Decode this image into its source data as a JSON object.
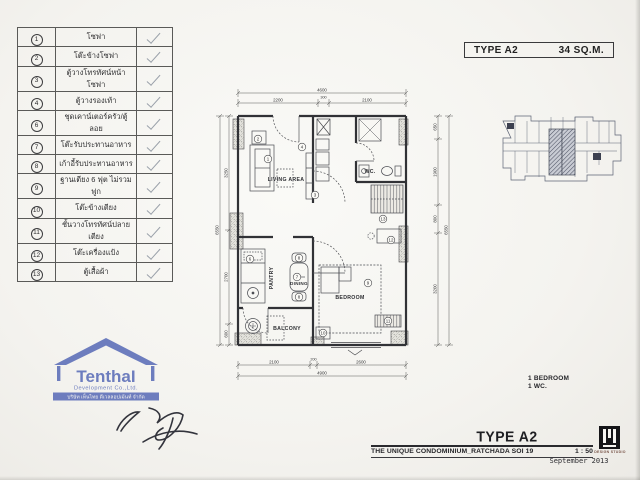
{
  "header_box": {
    "type_label": "TYPE A2",
    "area_label": "34 SQ.M."
  },
  "checklist": {
    "items": [
      {
        "num": "1",
        "label": "โซฟา",
        "checked": true
      },
      {
        "num": "2",
        "label": "โต๊ะข้างโซฟา",
        "checked": true
      },
      {
        "num": "3",
        "label": "ตู้วางโทรทัศน์หน้าโซฟา",
        "checked": true
      },
      {
        "num": "4",
        "label": "ตู้วางรองเท้า",
        "checked": true
      },
      {
        "num": "6",
        "label": "ชุดเคาน์เตอร์ครัว/ตู้ลอย",
        "checked": true
      },
      {
        "num": "7",
        "label": "โต๊ะรับประทานอาหาร",
        "checked": true
      },
      {
        "num": "8",
        "label": "เก้าอี้รับประทานอาหาร",
        "checked": true
      },
      {
        "num": "9",
        "label": "ฐานเตียง 6 ฟุต ไม่รวมฟูก",
        "checked": true
      },
      {
        "num": "10",
        "label": "โต๊ะข้างเตียง",
        "checked": true
      },
      {
        "num": "11",
        "label": "ชั้นวางโทรทัศน์ปลายเตียง",
        "checked": true
      },
      {
        "num": "12",
        "label": "โต๊ะเครื่องแป้ง",
        "checked": true
      },
      {
        "num": "13",
        "label": "ตู้เสื้อผ้า",
        "checked": true
      }
    ]
  },
  "plan": {
    "rooms": {
      "living": "LIVING AREA",
      "wc": "WC.",
      "pantry": "PANTRY",
      "dining": "DINING",
      "bedroom": "BEDROOM",
      "balcony": "BALCONY"
    },
    "callouts": {
      "c1": "1",
      "c2": "2",
      "c3": "3",
      "c4": "4",
      "c6": "6",
      "c7": "7",
      "c8": "8",
      "c9": "9",
      "c10": "10",
      "c11": "11",
      "c12": "12",
      "c13": "13"
    },
    "dims": {
      "top_total": "4600",
      "top_segments": [
        "2200",
        "300",
        "2100"
      ],
      "bottom_total": "4900",
      "bottom_segments": [
        "2100",
        "200",
        "2600"
      ],
      "left_total": "6550",
      "left_segments": [
        "3250",
        "2700",
        "600"
      ],
      "right_total": "6550",
      "right_segments": [
        "650",
        "1900",
        "800",
        "3200"
      ]
    }
  },
  "summary": {
    "line1": "1 BEDROOM",
    "line2": "1 WC."
  },
  "stamp": {
    "brand": "TenthaI",
    "company": "Development Co.,Ltd.",
    "thai_line": "บริษัท เท็นไทย ดีเวลลอปเม้นท์ จำกัด",
    "color": "#5b6db8"
  },
  "title_block": {
    "type_label": "TYPE A2",
    "project": "THE UNIQUE CONDOMINIUM_RATCHADA SOI 19",
    "scale": "1 : 50",
    "studio": "DESIGN STUDIO",
    "date": "September 2013"
  }
}
